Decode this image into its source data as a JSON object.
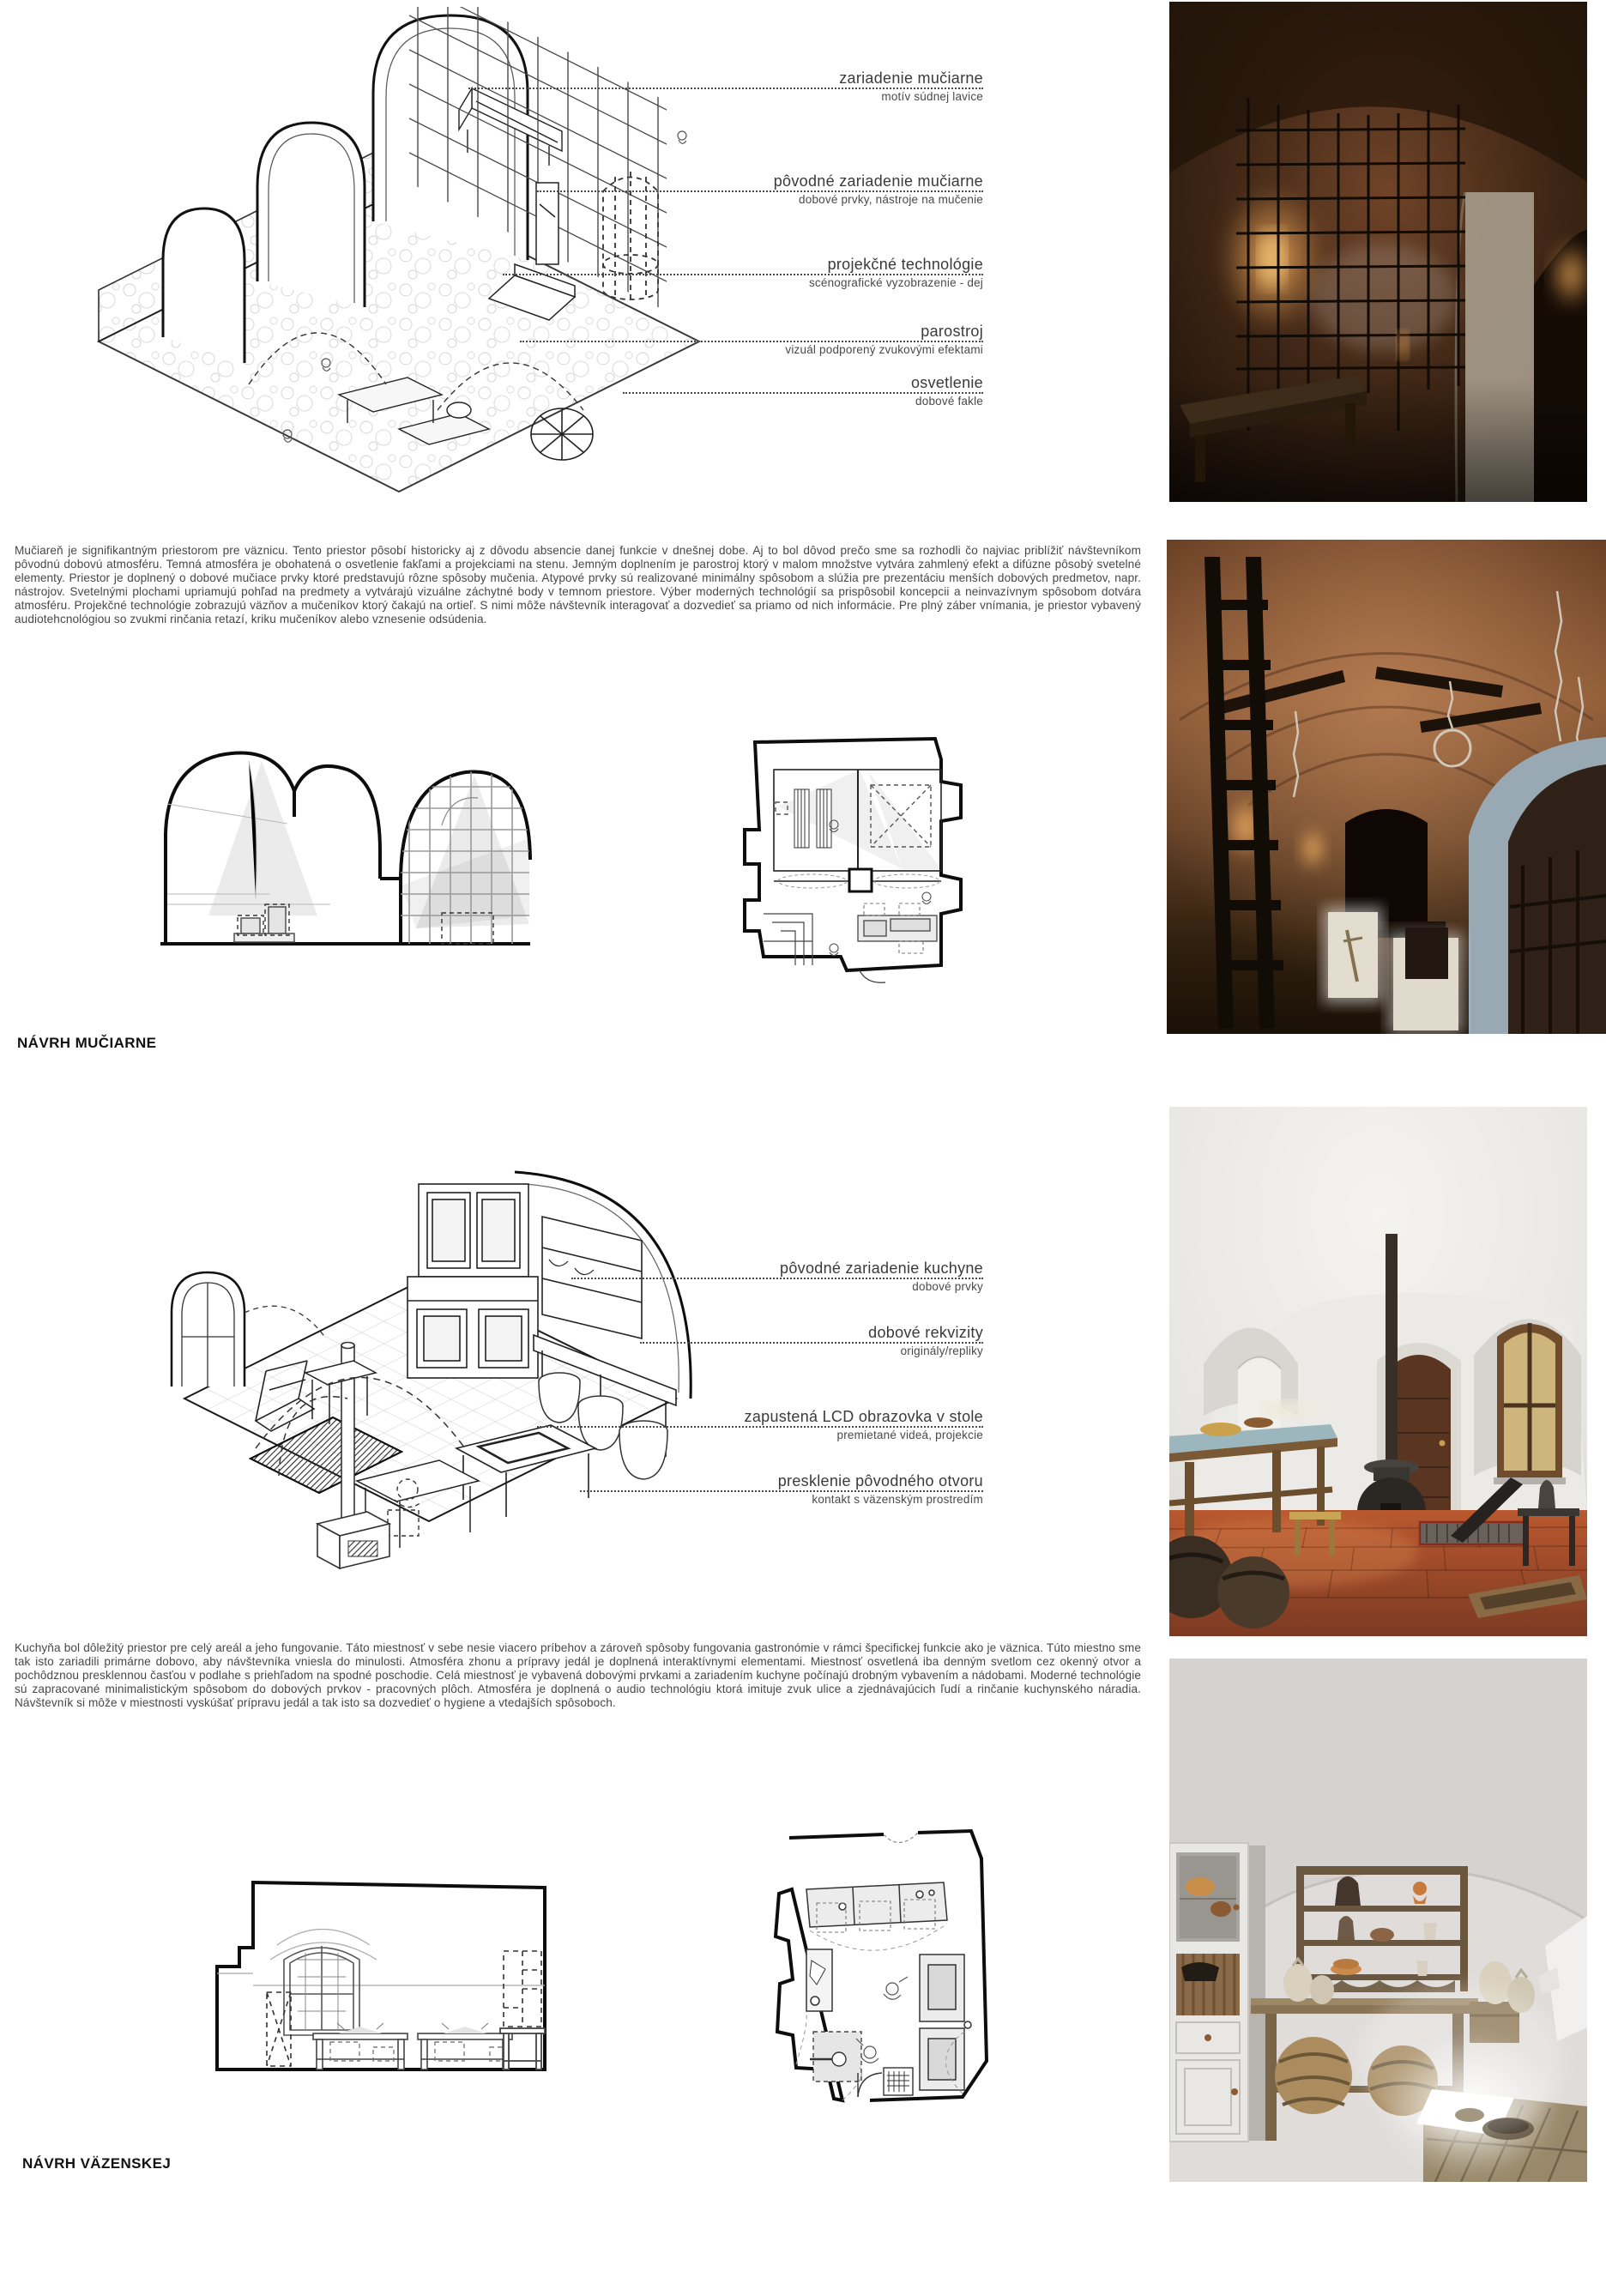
{
  "colors": {
    "paper": "#ffffff",
    "ink": "#3f3f3f",
    "label_ink": "#121212",
    "leader": "#4a4a4a"
  },
  "sections": {
    "muciaren": {
      "label": "NÁVRH MUČIARNE",
      "paragraph": "Mučiareň je signifikantným priestorom pre väznicu. Tento priestor pôsobí historicky aj z dôvodu absencie danej funkcie v dnešnej dobe. Aj to bol dôvod prečo sme sa rozhodli čo najviac priblížiť návštevníkom pôvodnú dobovú atmosféru. Temná atmosféra je obohatená o osvetlenie fakľami a projekciami na stenu. Jemným doplnením je parostroj ktorý v malom množstve vytvára zahmlený efekt a difúzne pôsobý svetelné elementy. Priestor je doplnený o dobové mučiace prvky ktoré predstavujú rôzne spôsoby mučenia. Atypové prvky sú realizované minimálny spôsobom a slúžia pre prezentáciu menších dobových predmetov, napr. nástrojov. Svetelnými plochami upriamujú pohľad na predmety a vytvárajú vizuálne záchytné body v temnom priestore. Výber moderných technológií sa prispôsobil koncepcii a neinvazívnym spôsobom dotvára atmosféru. Projekčné technológie zobrazujú väzňov a mučeníkov ktorý čakajú na ortieľ. S nimi môže návštevník interagovať a dozvedieť sa priamo od nich informácie. Pre plný záber vnímania, je priestor vybavený audiotehcnológiou so zvukmi rinčania retazí, kriku mučeníkov alebo vznesenie odsúdenia.",
      "callouts": [
        {
          "title": "zariadenie mučiarne",
          "subtitle": "motív súdnej lavice"
        },
        {
          "title": "pôvodné zariadenie mučiarne",
          "subtitle": "dobové prvky, nástroje na mučenie"
        },
        {
          "title": "projekčné technológie",
          "subtitle": "scénografické vyzobrazenie - dej"
        },
        {
          "title": "parostroj",
          "subtitle": "vizuál podporený zvukovými efektami"
        },
        {
          "title": "osvetlenie",
          "subtitle": "dobové fakle"
        }
      ]
    },
    "kuchyna": {
      "label": "NÁVRH VÄZENSKEJ",
      "paragraph": "Kuchyňa bol dôležitý priestor pre celý areál a jeho fungovanie. Táto miestnosť v sebe nesie viacero príbehov a zároveň spôsoby fungovania gastronómie v rámci špecifickej funkcie ako je väznica. Túto miestno sme tak isto zariadili primárne dobovo, aby návštevníka vniesla do minulosti. Atmosféra zhonu a prípravy jedál je doplnená interaktívnymi elementami. Miestnosť osvetlená iba denným svetlom cez okenný otvor a pochôdznou presklennou časťou v podlahe s priehľadom na spodné poschodie. Celá miestnosť je vybavená dobovými prvkami a zariadením kuchyne počínajú drobným vybavením a nádobami. Moderné technológie sú zapracované minimalistickým spôsobom do dobových prvkov - pracovných plôch.  Atmosféra je doplnená o audio technológiu ktorá imituje zvuk ulice a zjednávajúcich ľudí a rinčanie kuchynského náradia. Návštevník si môže v miestnosti vyskúšať prípravu jedál a tak isto sa dozvedieť o hygiene a vtedajších spôsoboch.",
      "callouts": [
        {
          "title": "pôvodné zariadenie kuchyne",
          "subtitle": "dobové prvky"
        },
        {
          "title": "dobové rekvizity",
          "subtitle": "originály/repliky"
        },
        {
          "title": "zapustená LCD obrazovka v stole",
          "subtitle": "premietané videá, projekcie"
        },
        {
          "title": "presklenie pôvodného otvoru",
          "subtitle": "kontakt s väzenským prostredím"
        }
      ]
    }
  }
}
